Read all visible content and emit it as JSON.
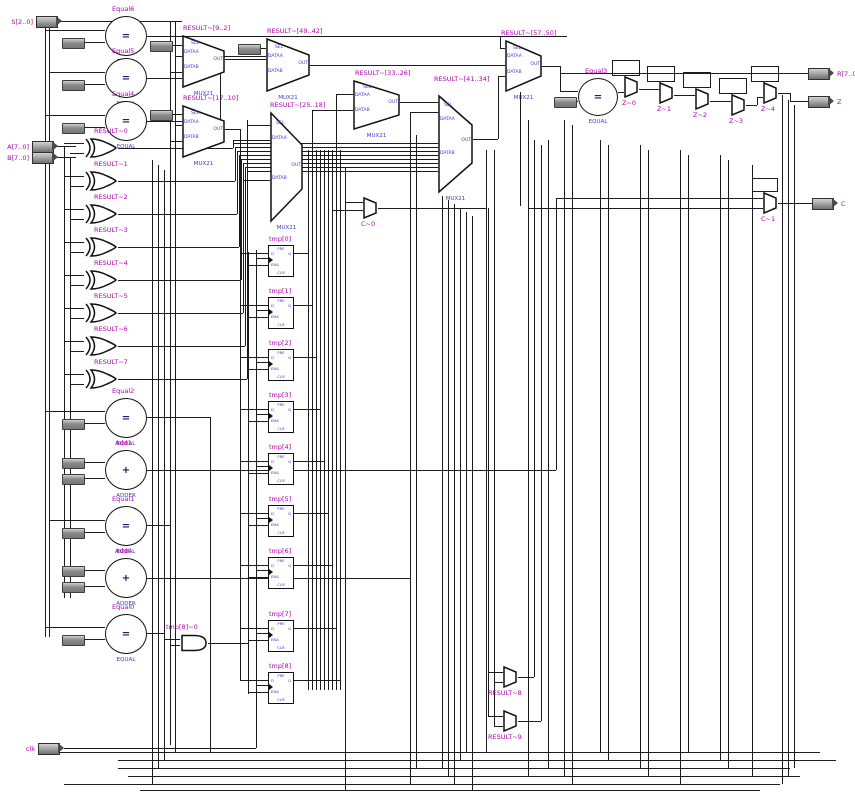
{
  "ports": {
    "sel": "SEL",
    "dataa": "DATAA",
    "datab": "DATAB",
    "out": "OUT",
    "pre": "PRE",
    "d": "D",
    "q": "Q",
    "ena": "ENA",
    "clr": "CLR"
  },
  "types": {
    "mux": "MUX21",
    "equal": "EQUAL",
    "adder": "ADDER"
  },
  "symbols": {
    "equal": "=",
    "add": "+"
  },
  "input_pins": [
    {
      "label": "S[2..0]"
    },
    {
      "label": "A[7..0]"
    },
    {
      "label": "B[7..0]"
    },
    {
      "label": "clk"
    }
  ],
  "output_pins": [
    {
      "label": "R[7..0]"
    },
    {
      "label": "Z"
    },
    {
      "label": "C"
    }
  ],
  "equals": [
    {
      "name": "Equal6"
    },
    {
      "name": "Equal5"
    },
    {
      "name": "Equal4"
    },
    {
      "name": "Equal3"
    },
    {
      "name": "Equal2"
    },
    {
      "name": "Equal1"
    },
    {
      "name": "Equal0"
    }
  ],
  "adders": [
    {
      "name": "Add1"
    },
    {
      "name": "Add0"
    }
  ],
  "xors": [
    {
      "name": "RESULT~0"
    },
    {
      "name": "RESULT~1"
    },
    {
      "name": "RESULT~2"
    },
    {
      "name": "RESULT~3"
    },
    {
      "name": "RESULT~4"
    },
    {
      "name": "RESULT~5"
    },
    {
      "name": "RESULT~6"
    },
    {
      "name": "RESULT~7"
    }
  ],
  "muxes": [
    {
      "name": "RESULT~[9..2]"
    },
    {
      "name": "RESULT~[17..10]"
    },
    {
      "name": "RESULT~[49..42]"
    },
    {
      "name": "RESULT~[25..18]"
    },
    {
      "name": "RESULT~[33..26]"
    },
    {
      "name": "RESULT~[41..34]"
    },
    {
      "name": "RESULT~[57..50]"
    }
  ],
  "small_muxes": [
    {
      "name": "C~0"
    },
    {
      "name": "C~1"
    },
    {
      "name": "Z~0"
    },
    {
      "name": "Z~1"
    },
    {
      "name": "Z~2"
    },
    {
      "name": "Z~3"
    },
    {
      "name": "Z~4"
    },
    {
      "name": "RESULT~8"
    },
    {
      "name": "RESULT~9"
    }
  ],
  "dffs": [
    {
      "name": "tmp[0]"
    },
    {
      "name": "tmp[1]"
    },
    {
      "name": "tmp[2]"
    },
    {
      "name": "tmp[3]"
    },
    {
      "name": "tmp[4]"
    },
    {
      "name": "tmp[5]"
    },
    {
      "name": "tmp[6]"
    },
    {
      "name": "tmp[7]"
    },
    {
      "name": "tmp[8]"
    }
  ],
  "and_gate": {
    "name": "tmp[8]~0"
  }
}
